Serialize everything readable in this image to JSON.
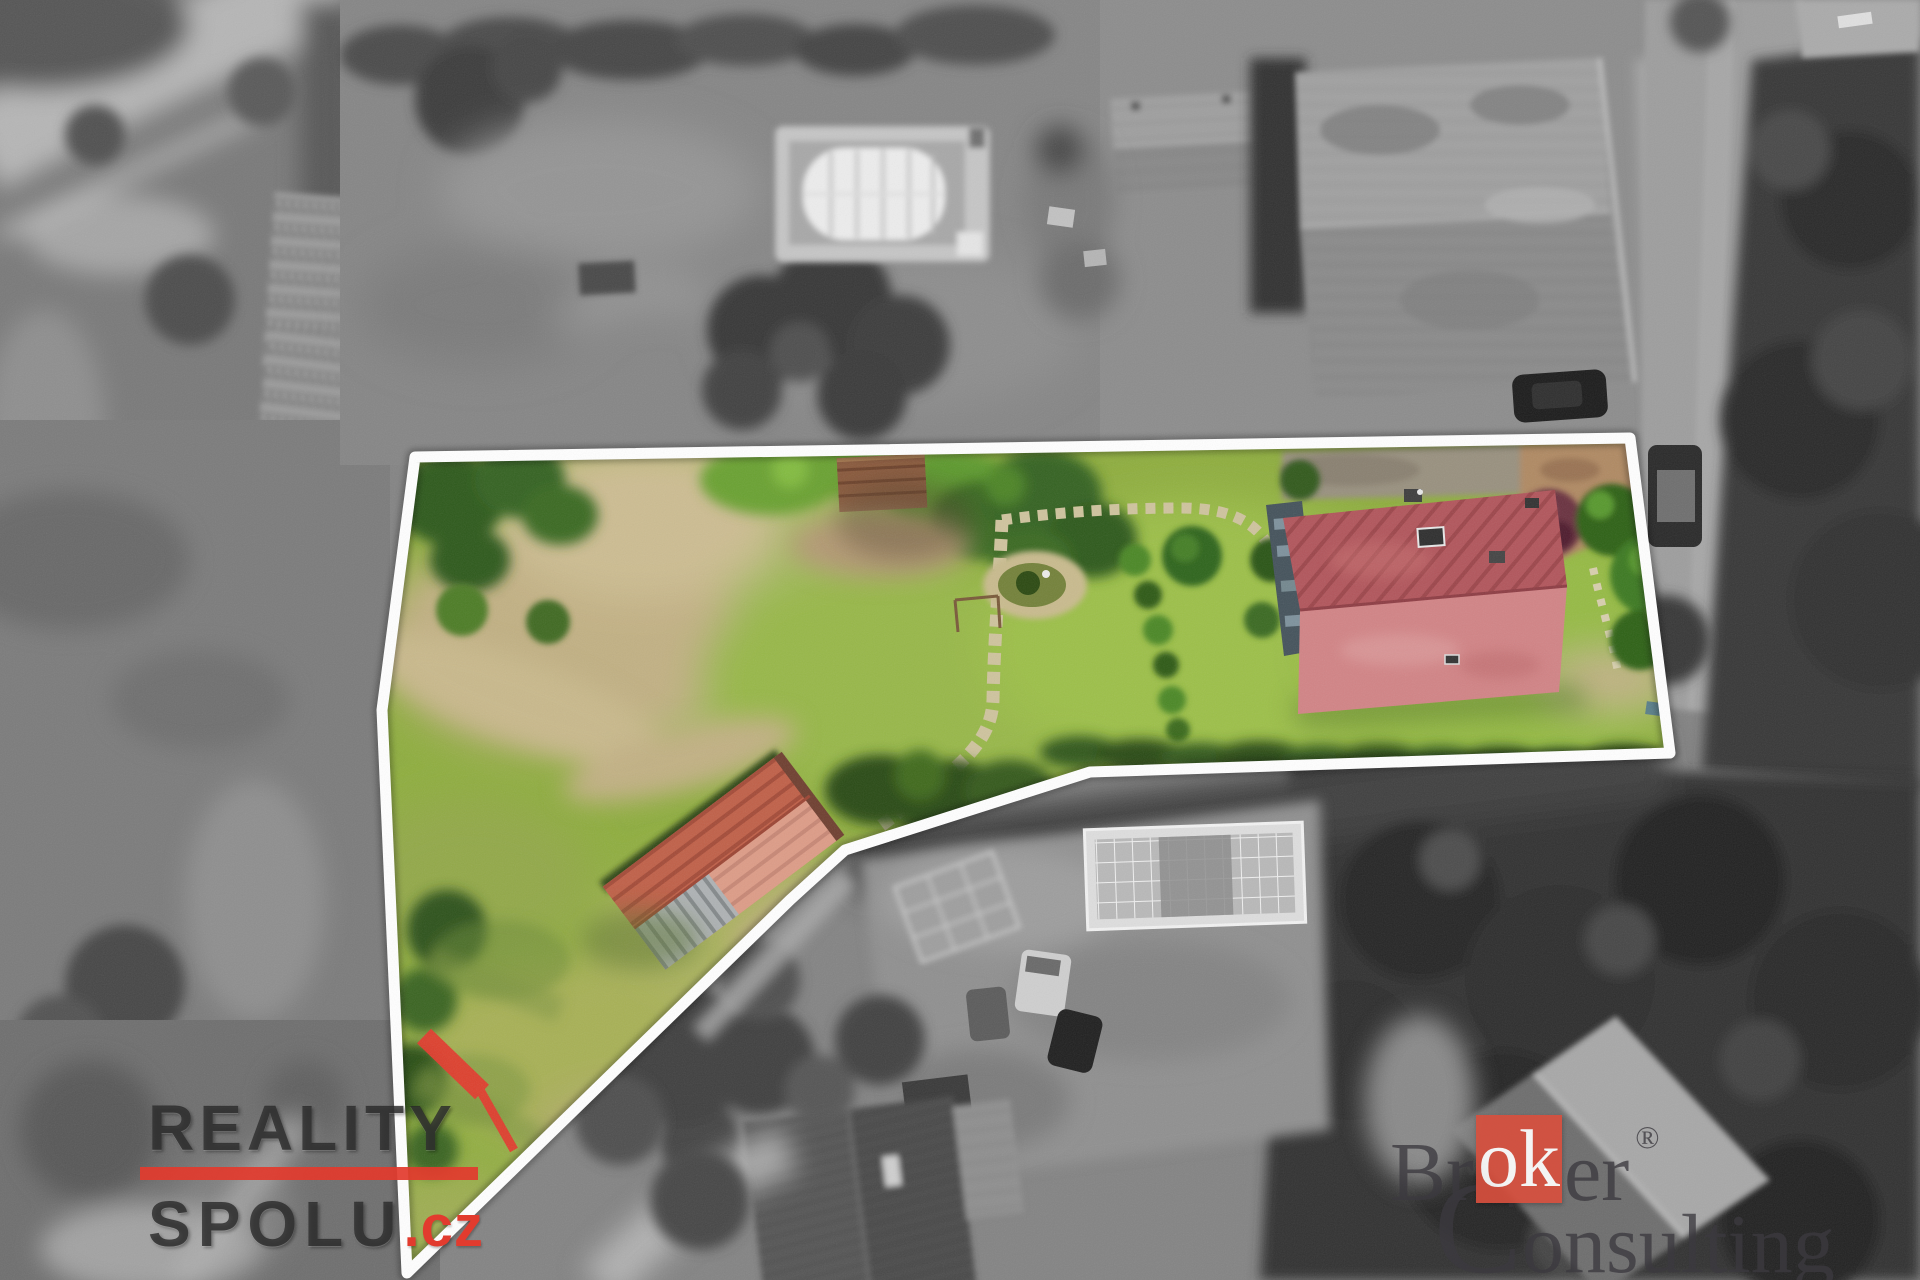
{
  "scene": {
    "boundary_color": "#ffffff",
    "plot_polygon_points": "415,457 1630,438 1670,753 1090,772 845,850 790,900 407,1273 382,710",
    "lawn_color": "#8fae3f",
    "house_roof_upper_color": "#b2565c",
    "house_roof_lower_color": "#d28486",
    "shed_roof_color": "#cb7a62",
    "accent_red": "#e23b2e"
  },
  "watermarks": {
    "reality_spolu": {
      "line1": "REALITY",
      "line2": "SPOLU",
      "tld": ".cz",
      "accent_color": "#e23b2e"
    },
    "broker_consulting": {
      "part1": "Br",
      "highlight": "ok",
      "part2": "er",
      "registered": "®",
      "line2_cap": "C",
      "line2_rest": "onsulting",
      "square_color": "#d8503e"
    }
  }
}
